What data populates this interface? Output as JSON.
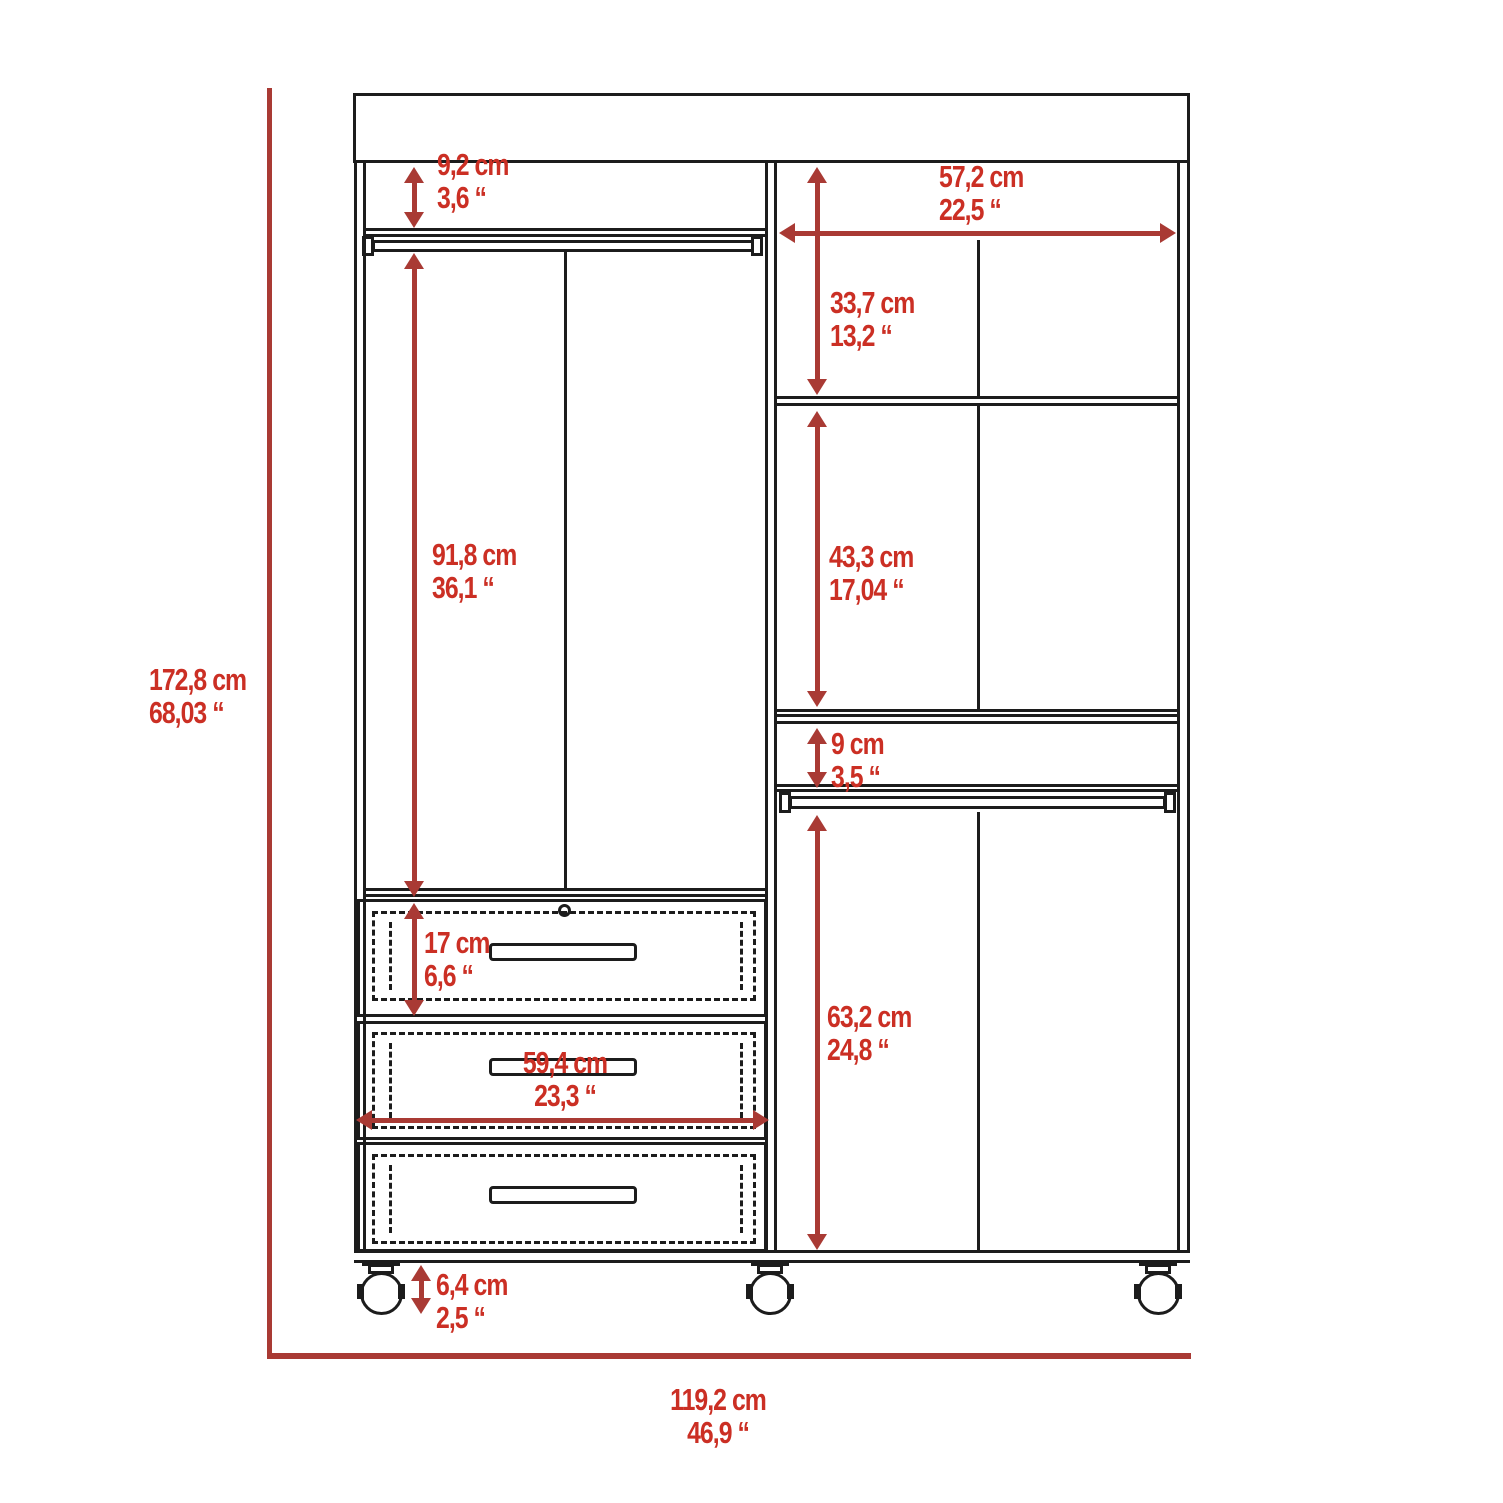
{
  "diagram_type": "furniture-dimension-drawing",
  "subject": "three-section wardrobe closet with drawers and casters",
  "colors": {
    "dimension_text": "#cb2f24",
    "dimension_line": "#a93a34",
    "outline": "#1c1c1c",
    "background": "#ffffff"
  },
  "dimensions": {
    "overall_height": {
      "cm": "172,8 cm",
      "inch": "68,03 “"
    },
    "overall_width": {
      "cm": "119,2 cm",
      "inch": "46,9 “"
    },
    "left_top_gap": {
      "cm": "9,2 cm",
      "inch": "3,6 “"
    },
    "left_hanging_height": {
      "cm": "91,8 cm",
      "inch": "36,1 “"
    },
    "right_interior_width": {
      "cm": "57,2 cm",
      "inch": "22,5 “"
    },
    "right_top_section": {
      "cm": "33,7 cm",
      "inch": "13,2 “"
    },
    "right_middle_section": {
      "cm": "43,3 cm",
      "inch": "17,04 “"
    },
    "right_rod_gap": {
      "cm": "9 cm",
      "inch": "3,5 “"
    },
    "right_lower_section": {
      "cm": "63,2 cm",
      "inch": "24,8 “"
    },
    "drawer_height": {
      "cm": "17 cm",
      "inch": "6,6 “"
    },
    "drawer_width": {
      "cm": "59,4 cm",
      "inch": "23,3 “"
    },
    "caster_height": {
      "cm": "6,4 cm",
      "inch": "2,5 “"
    }
  }
}
